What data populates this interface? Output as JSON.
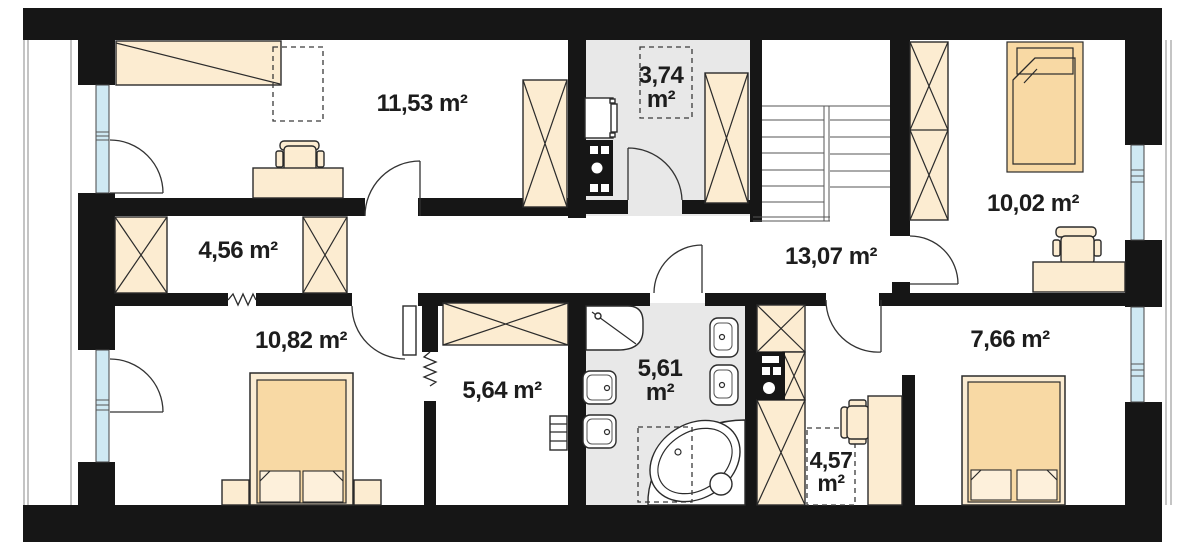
{
  "plan_type": "floor-plan",
  "colors": {
    "wall": "#161616",
    "furniture_fill": "#fcecd1",
    "bed_fill": "#f8d9a4",
    "floor_gray": "#e8e8e8",
    "window_glass": "#cfe9f3",
    "text": "#1d1d1d"
  },
  "rooms": [
    {
      "id": "room-top-left",
      "label": "11,53 m²"
    },
    {
      "id": "utility-room",
      "value": "3,74",
      "unit": "m²"
    },
    {
      "id": "corridor",
      "label": "4,56 m²"
    },
    {
      "id": "hall",
      "label": "13,07 m²"
    },
    {
      "id": "bedroom-top-right",
      "label": "10,02 m²"
    },
    {
      "id": "bedroom-bottom-left",
      "label": "10,82 m²"
    },
    {
      "id": "dressing-room",
      "label": "5,64 m²"
    },
    {
      "id": "bathroom",
      "value": "5,61",
      "unit": "m²"
    },
    {
      "id": "bedroom-bottom-right",
      "label": "7,66 m²"
    },
    {
      "id": "alcove",
      "value": "4,57",
      "unit": "m²"
    }
  ]
}
